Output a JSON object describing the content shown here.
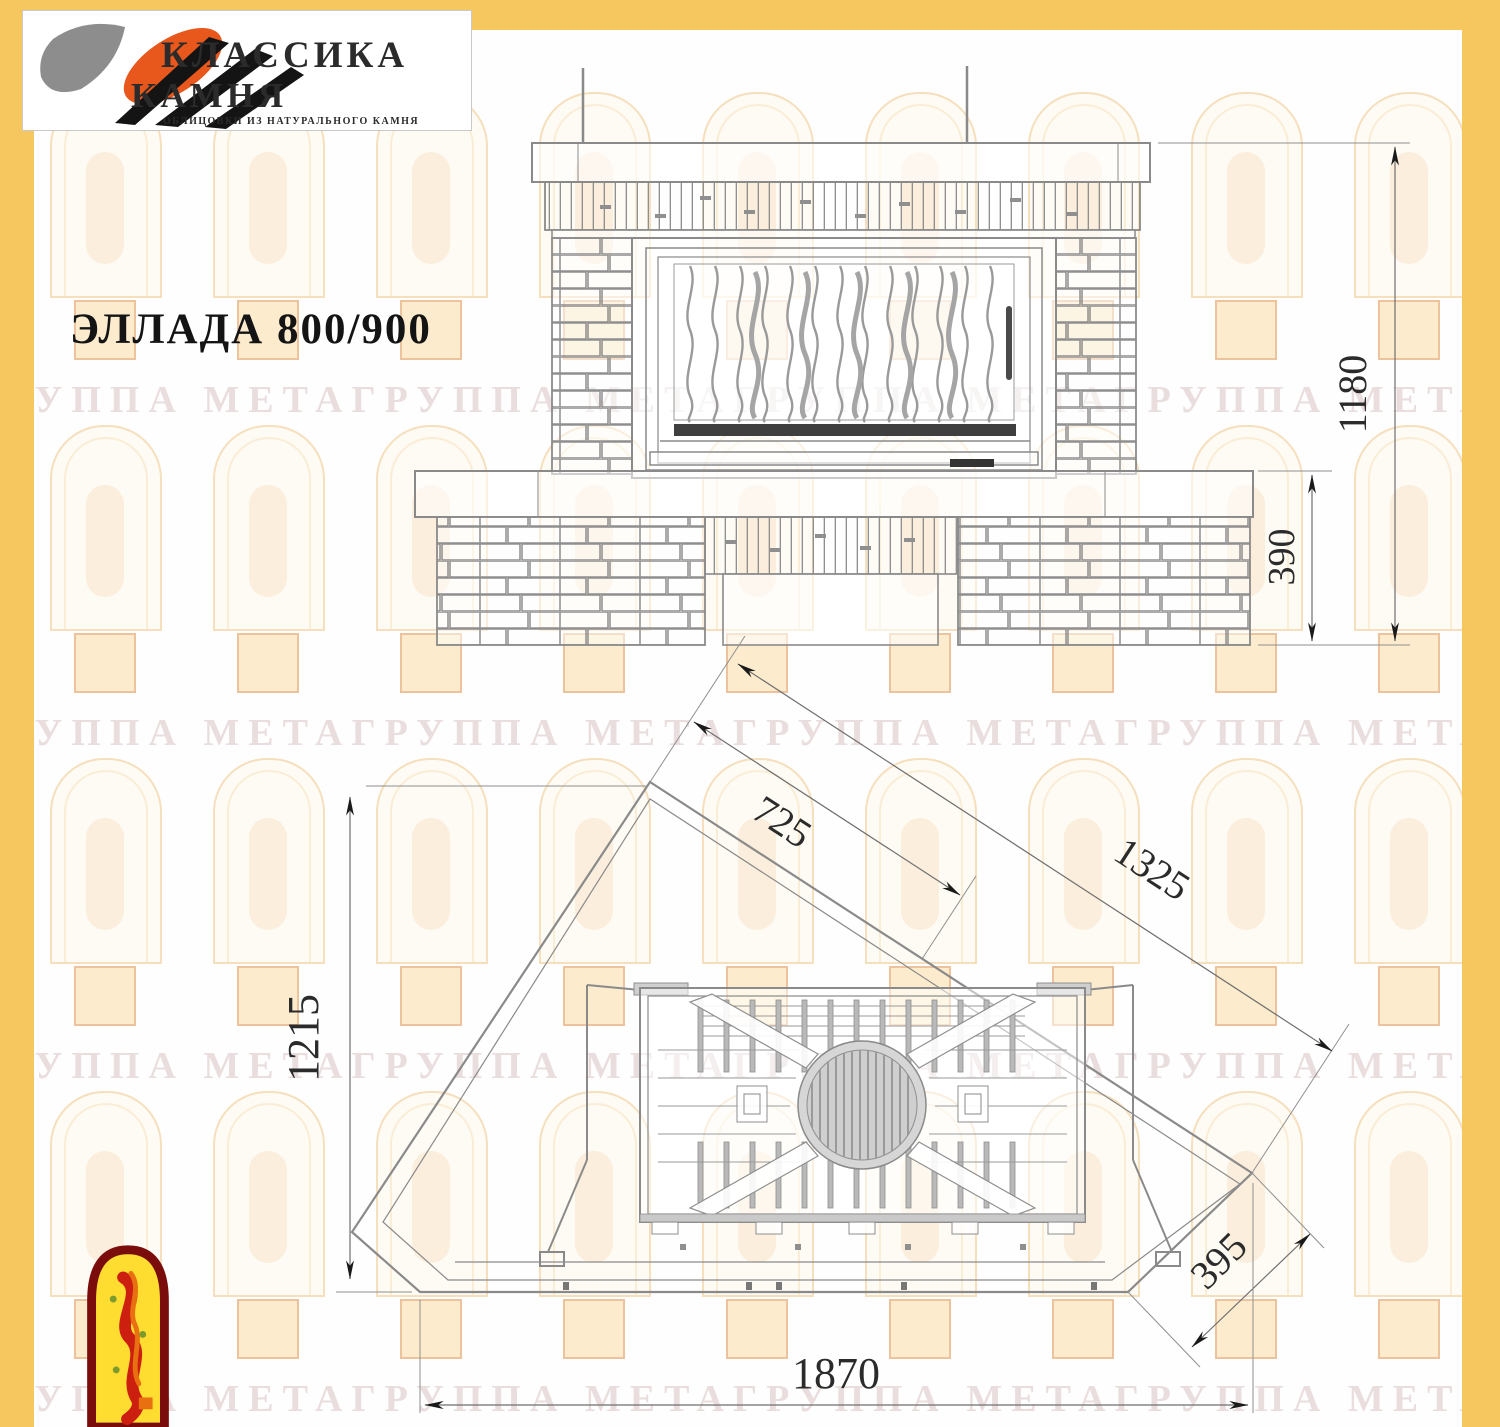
{
  "branding": {
    "logo_title": "КЛАССИКА",
    "logo_subtitle": "КАМНЯ",
    "logo_tagline": "ОБЛИЦОВКИ ИЗ НАТУРАЛЬНОГО КАМНЯ"
  },
  "title": "ЭЛЛАДА 800/900",
  "watermark_text": "ГРУППА МЕТАГРУППА МЕТАГРУППА МЕТАГРУППА МЕТА",
  "colors": {
    "border_yellow": "#f6c75e",
    "drawing_line_gray": "#8a8a8a",
    "dimension_text": "#2b2b2b",
    "logo_orange": "#e8581c",
    "emblem_border_red": "#7a0c0c",
    "emblem_yellow": "#ffdd30"
  },
  "front_view": {
    "dim_total_height": "1180",
    "dim_base_height": "390"
  },
  "plan_view": {
    "dim_side_depth": "1215",
    "dim_portal_diag": "725",
    "dim_facade_diag": "1325",
    "dim_chamfer": "395",
    "dim_front_width": "1870"
  }
}
